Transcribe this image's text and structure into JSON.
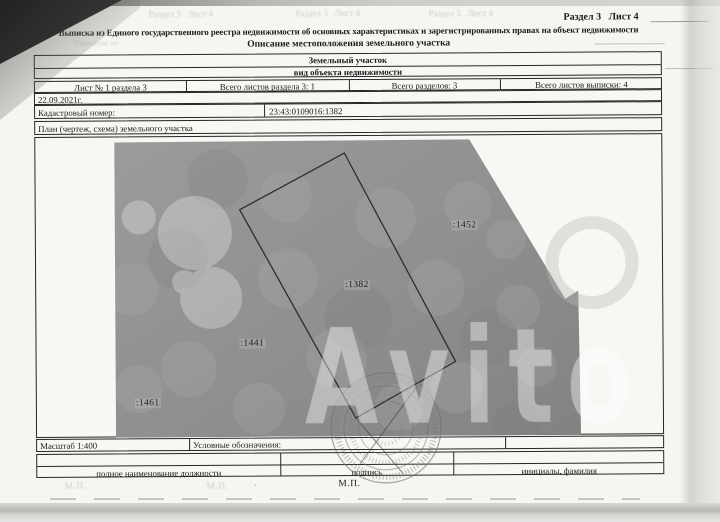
{
  "palette": {
    "paper": "#f6f5f1",
    "map_gray": "#919191",
    "ink": "#1b1b1b"
  },
  "header": {
    "section": "Раздел 3   Лист 4",
    "ghost_sections": [
      "Раздел 3   Лист 4",
      "Раздел 3   Лист 4",
      "Раздел 3   Лист 4"
    ],
    "title": "Выписка из Единого государственного реестра недвижимости об основных характеристиках и зарегистрированных правах на объект недвижимости",
    "subtitle": "Описание местоположения земельного участка",
    "ghost_subtitle": "Описание ме"
  },
  "object_box": {
    "value": "Земельный участок",
    "caption": "вид объекта недвижимости"
  },
  "sheet_info": [
    "Лист № 1 раздела 3",
    "Всего листов раздела 3: 1",
    "Всего разделов: 3",
    "Всего листов выписки: 4"
  ],
  "date": "22.09.2021г.",
  "cadastral": {
    "label": "Кадастровый номер:",
    "value": "23:43:0109016:1382"
  },
  "plan": {
    "header": "План (чертеж, схема) земельного участка",
    "parcels": [
      ":1452",
      ":1382",
      ":1441",
      ":1461"
    ],
    "watermark": "Avito"
  },
  "footer": {
    "scale": "Масштаб 1:400",
    "legend": "Условные обозначения:",
    "sig_cols": [
      "полное наименование должности",
      "подпись",
      "инициалы, фамилия"
    ],
    "stamp_mark": "М.П.",
    "ghost_marks": [
      "М.П.",
      "М.П."
    ]
  }
}
